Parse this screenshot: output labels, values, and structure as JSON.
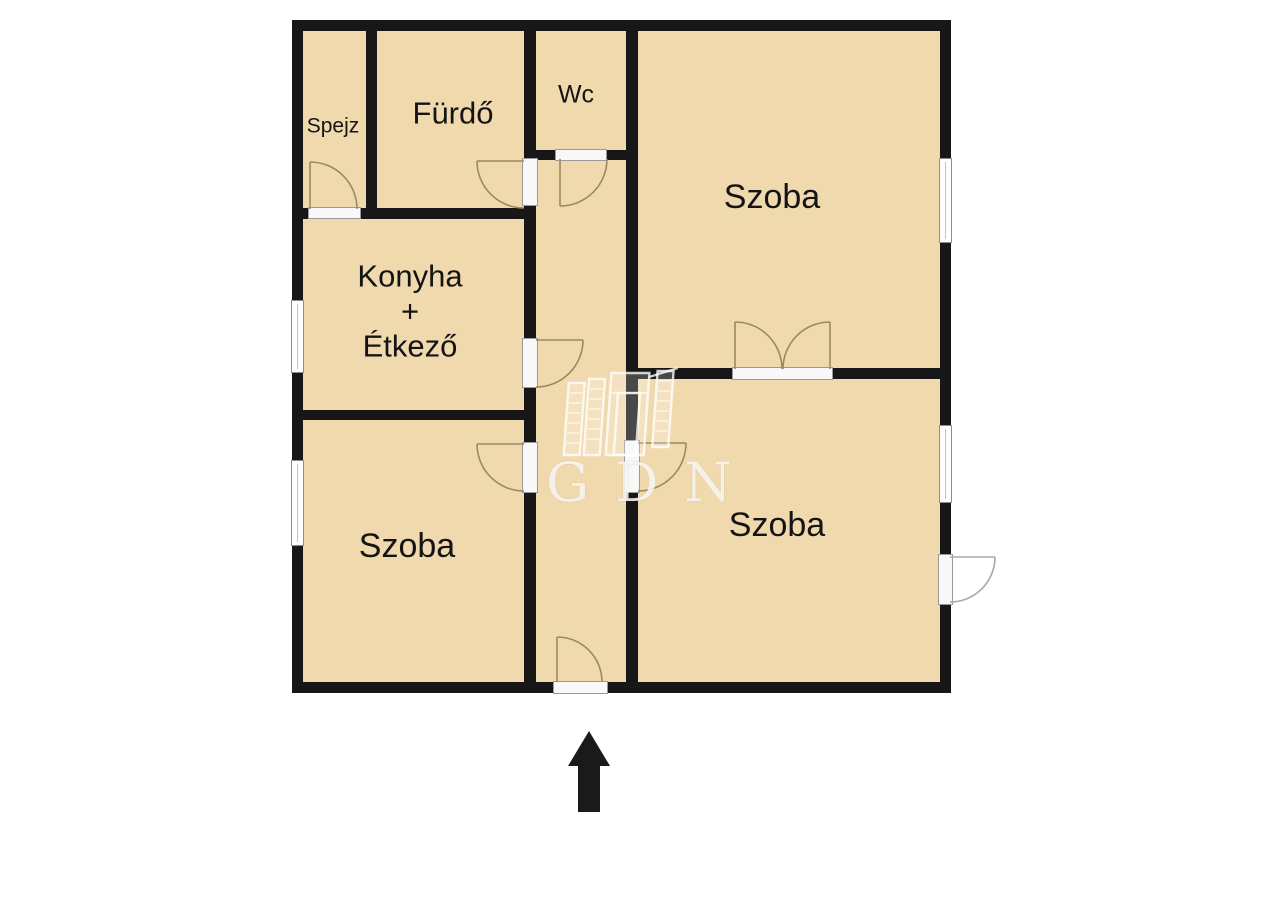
{
  "plan": {
    "type": "floor-plan",
    "colors": {
      "floor_fill": "#f1d9ae",
      "wall": "#171717",
      "door_arc": "#9b8962",
      "exterior_door_arc": "#a8a8a8",
      "sill_border": "#9a9a9a",
      "window_border": "#8e8e8e",
      "label_text": "#141414",
      "background": "#ffffff"
    },
    "rooms": {
      "spejz": {
        "label": "Spejz"
      },
      "furdo": {
        "label": "Fürdő"
      },
      "wc": {
        "label": "Wc"
      },
      "szoba_top_right": {
        "label": "Szoba"
      },
      "konyha_etkezo": {
        "line1": "Konyha",
        "line2": "+",
        "line3": "Étkező"
      },
      "szoba_bottom_left": {
        "label": "Szoba"
      },
      "szoba_bottom_right": {
        "label": "Szoba"
      }
    },
    "watermark": {
      "text": "GDN"
    },
    "icons": {
      "north_arrow": "up-arrow",
      "watermark_logo": "building-columns"
    }
  }
}
